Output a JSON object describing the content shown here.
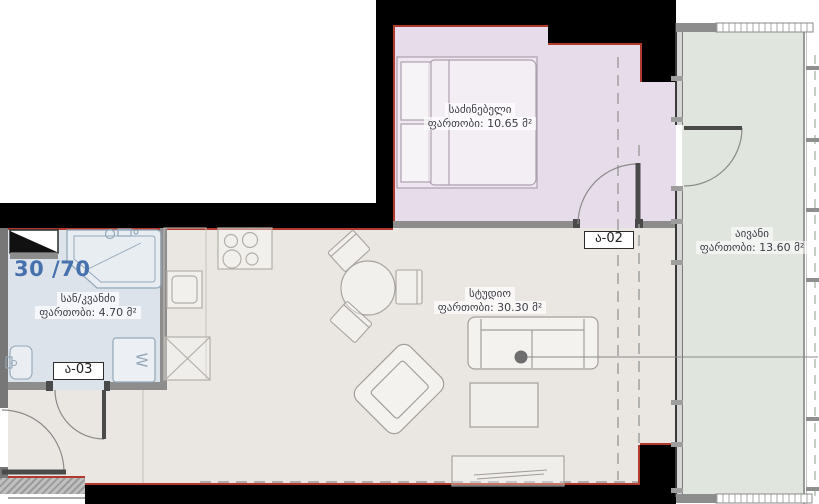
{
  "plan": {
    "unit_ratio": "30 /70",
    "rooms": [
      {
        "id": "bedroom",
        "name": "საძინებელი",
        "area_label": "ფართობი: 10.65 მ²",
        "color": "#e7dcea"
      },
      {
        "id": "studio",
        "name": "სტუდიო",
        "area_label": "ფართობი: 30.30 მ²",
        "color": "#eae7e2"
      },
      {
        "id": "balcony",
        "name": "აივანი",
        "area_label": "ფართობი: 13.60 მ²",
        "color": "#e0e6dd"
      },
      {
        "id": "bathroom",
        "name": "სან/კვანძი",
        "area_label": "ფართობი: 4.70 მ²",
        "color": "#dce3eb"
      }
    ],
    "door_tags": {
      "bedroom": "ა-02",
      "bathroom": "ა-03"
    },
    "appliances": {
      "washer_label": "W"
    },
    "colors": {
      "wall": "#000000",
      "partition": "#8d8d8d",
      "accent": "#b03a2e",
      "text": "#3d3d47",
      "blue": "#4671ad"
    }
  }
}
